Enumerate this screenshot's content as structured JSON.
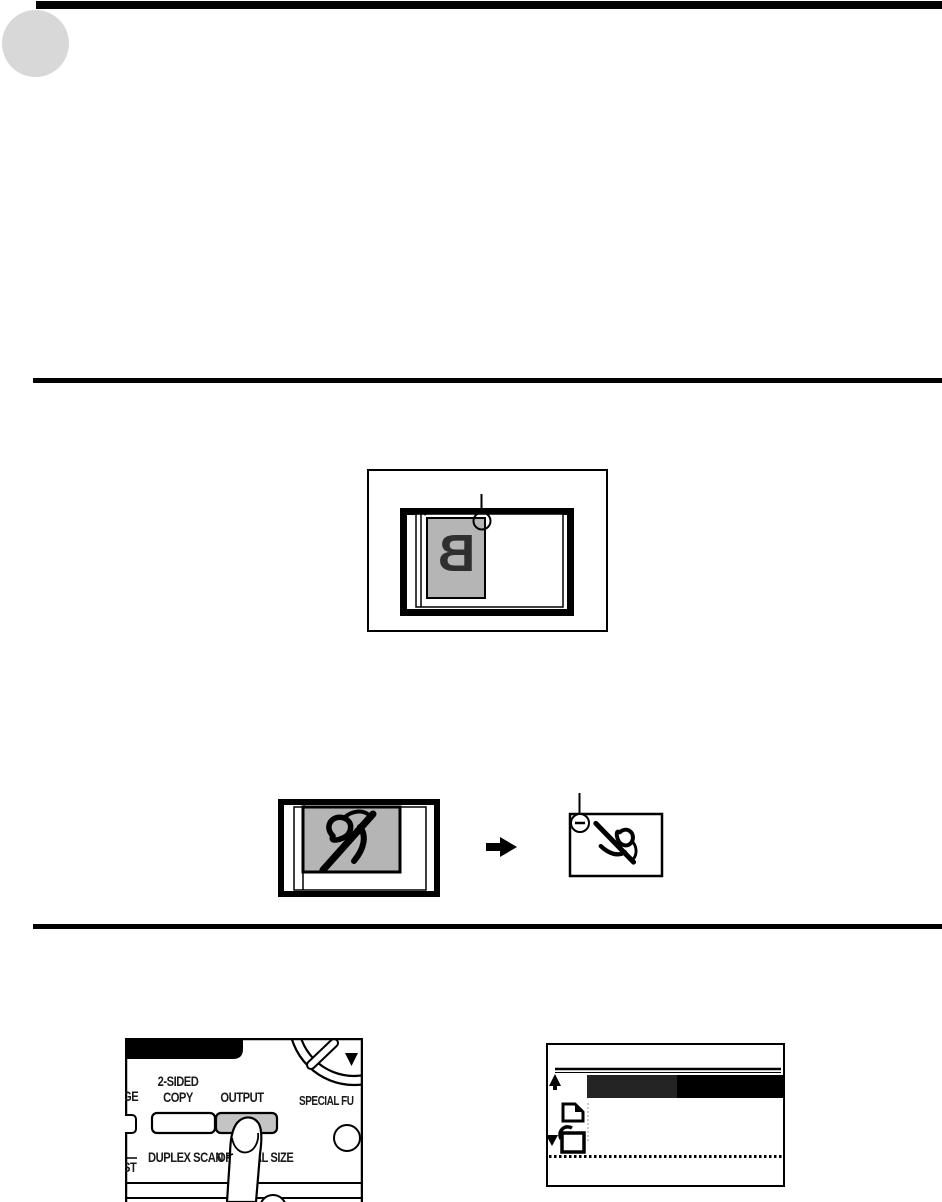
{
  "page": {
    "kind": "copier manual page (scan)",
    "background": "#ffffff"
  },
  "header": {
    "top_bar_color": "#000000",
    "corner_dot_color": "#d8d8d8"
  },
  "figure_platen": {
    "description": "original placed face down on document glass",
    "document_letter": "B",
    "document_fill": "#b5b5b5",
    "callout_icon": "corner-marker-circle"
  },
  "figure_rotation": {
    "description": "landscape original rotated on output copy",
    "document_fill": "#b5b5b5",
    "arrow_icon": "right-arrow",
    "callout_icon": "corner-marker-circle"
  },
  "control_panel": {
    "labels": {
      "two_sided_line1": "2-SIDED",
      "two_sided_line2": "COPY",
      "output": "OUTPUT",
      "special_function": "SPECIAL FU",
      "duplex_scan": "DUPLEX SCAN",
      "original_size": "ORIGINAL SIZE",
      "fragment_left_top": "GE",
      "fragment_left_bottom": "ST"
    },
    "colors": {
      "pressed_button_fill": "#c4c4c4",
      "header_bar": "#000000"
    },
    "icons": [
      "dial-ring-icon",
      "dial-handle-icon",
      "down-triangle-icon",
      "finger-press-icon"
    ]
  },
  "lcd_display": {
    "highlight_bar_left_color": "#242424",
    "highlight_bar_right_color": "#000000",
    "icons": [
      "sort-icon",
      "page-corner-icon",
      "down-triangle-icon",
      "rotate-page-icon"
    ]
  }
}
